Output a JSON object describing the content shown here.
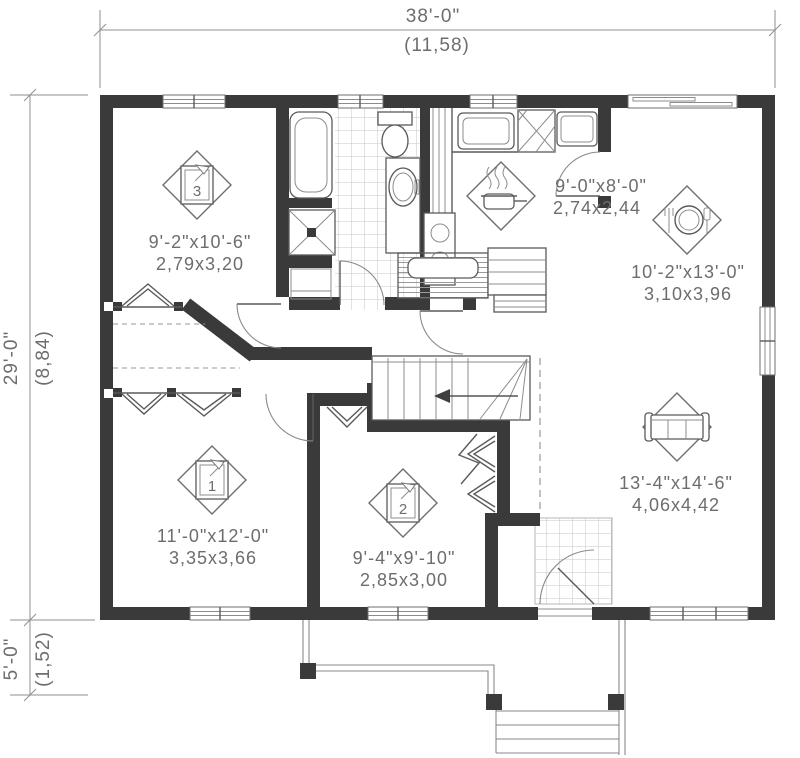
{
  "dimensions": {
    "width_imperial": "38'-0\"",
    "width_metric": "(11,58)",
    "height_imperial": "29'-0\"",
    "height_metric": "(8,84)",
    "porch_imperial": "5'-0\"",
    "porch_metric": "(1,52)"
  },
  "rooms": {
    "bedroom3": {
      "number": "3",
      "imperial": "9'-2\"x10'-6\"",
      "metric": "2,79x3,20"
    },
    "kitchen": {
      "imperial": "9'-0\"x8'-0\"",
      "metric": "2,74x2,44"
    },
    "dining": {
      "imperial": "10'-2\"x13'-0\"",
      "metric": "3,10x3,96"
    },
    "living": {
      "imperial": "13'-4\"x14'-6\"",
      "metric": "4,06x4,42"
    },
    "bedroom1": {
      "number": "1",
      "imperial": "11'-0\"x12'-0\"",
      "metric": "3,35x3,66"
    },
    "bedroom2": {
      "number": "2",
      "imperial": "9'-4\"x9'-10\"",
      "metric": "2,85x3,00"
    }
  },
  "icons": {
    "bedroom1_marker": "number-1-in-square",
    "bedroom2_marker": "number-2-in-square",
    "bedroom3_marker": "number-3-in-square",
    "kitchen_marker": "cooking-pot-with-steam",
    "dining_marker": "plate-with-cutlery",
    "living_marker": "sofa"
  },
  "colors": {
    "wall": "#3a3a3a",
    "line": "#8a8a8a",
    "text": "#6d6d6d",
    "tile": "#c6c6c6"
  }
}
